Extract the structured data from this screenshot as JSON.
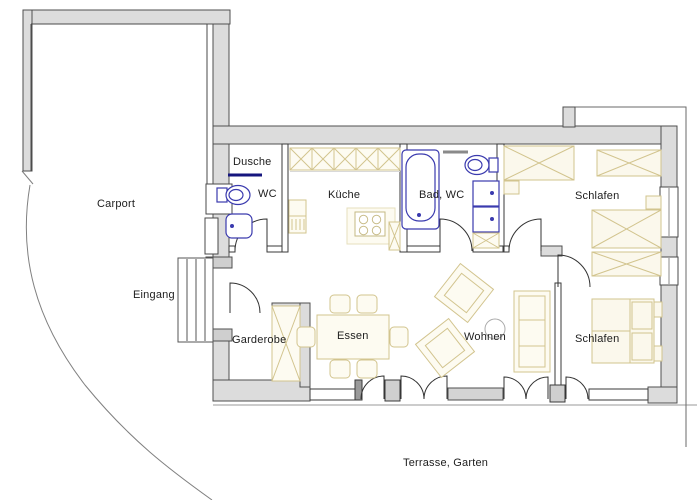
{
  "plan": {
    "labels": {
      "carport": "Carport",
      "eingang": "Eingang",
      "dusche": "Dusche",
      "wc": "WC",
      "kueche": "Küche",
      "bad_wc": "Bad, WC",
      "schlafen_top": "Schlafen",
      "schlafen_bottom": "Schlafen",
      "garderobe": "Garderobe",
      "essen": "Essen",
      "wohnen": "Wohnen",
      "terrasse": "Terrasse, Garten"
    },
    "colors": {
      "background": "#ffffff",
      "wall_fill": "#dcdcdc",
      "wall_edge": "#4f4f4f",
      "interior_wall_edge": "#3a3a3a",
      "furniture_line": "#d2c48e",
      "furniture_fill": "#fdfbf1",
      "fixture_blue": "#3a3aae",
      "shower_screen": "#16167e",
      "site_line": "#808080",
      "label_text": "#1d1d1d"
    }
  }
}
